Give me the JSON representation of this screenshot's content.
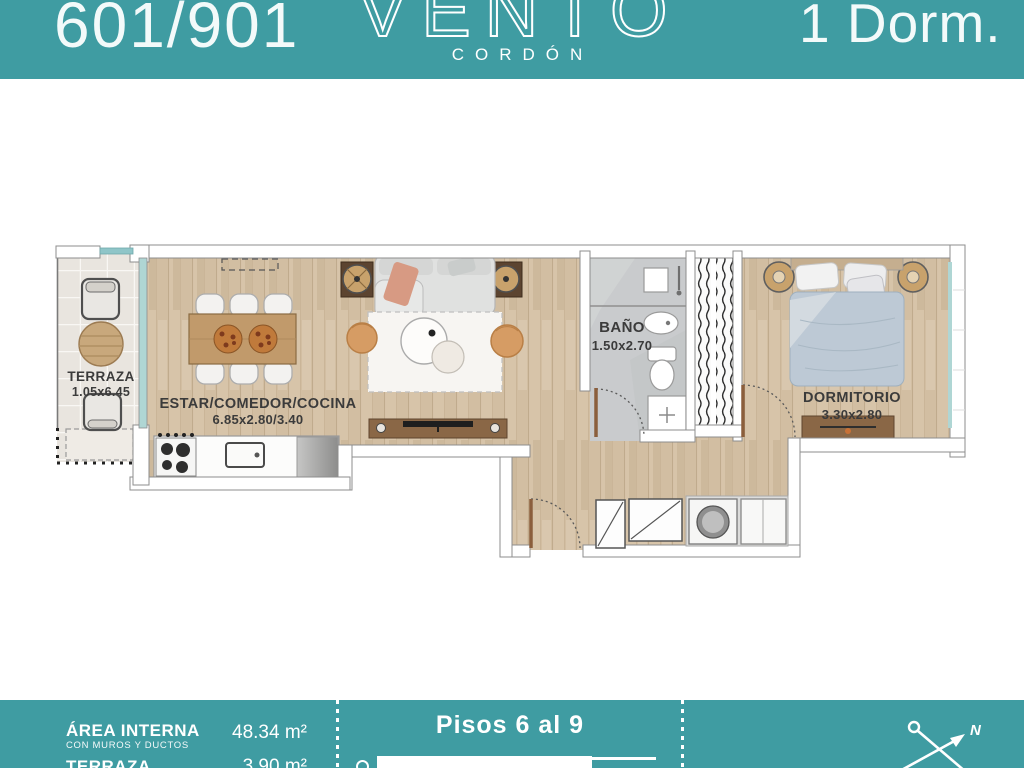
{
  "colors": {
    "accent_teal": "#3F9CA2",
    "wood_floor": "#D2BEA2",
    "bath_floor": "#C9CBCD",
    "label_dark": "#3B3B3B"
  },
  "header": {
    "unit_number": "601/901",
    "brand_name": "VENTO",
    "brand_subtitle": "CORDÓN",
    "unit_type": "1 Dorm."
  },
  "plan": {
    "rooms": [
      {
        "name": "TERRAZA",
        "dims": "1.05x6.45"
      },
      {
        "name": "ESTAR/COMEDOR/COCINA",
        "dims": "6.85x2.80/3.40"
      },
      {
        "name": "BAÑO",
        "dims": "1.50x2.70"
      },
      {
        "name": "DORMITORIO",
        "dims": "3.30x2.80"
      }
    ]
  },
  "footer": {
    "area_label": "ÁREA INTERNA",
    "area_sublabel": "CON MUROS Y DUCTOS",
    "area_value": "48.34 m²",
    "terrace_label": "TERRAZA",
    "terrace_value": "3.90 m²",
    "floors_label": "Pisos 6 al 9",
    "compass_north": "N"
  }
}
